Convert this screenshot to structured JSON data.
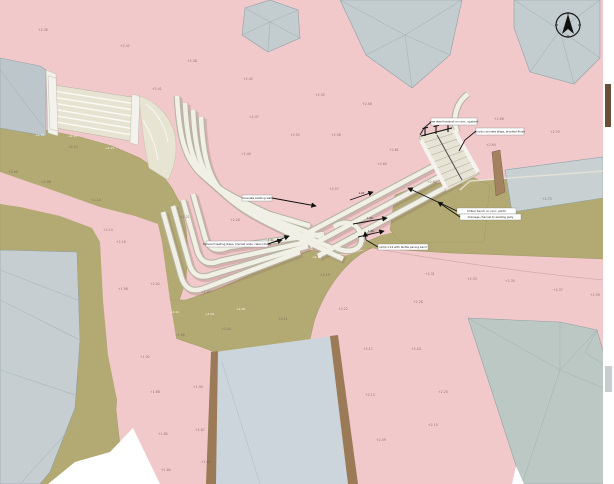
{
  "drawing": {
    "kind": "landscape site plan render",
    "colors": {
      "plaza_pink": "#f2c9cb",
      "path_olive": "#b3aa73",
      "water": "#ccd5dc",
      "water_edge_brown": "#9b7a58",
      "building_gray": "#c3ccce",
      "building_green_gray": "#bcc8c3",
      "steps_cream": "#f1f0e6",
      "steps_edge": "#b7b4a2",
      "timber": "#a3825f",
      "annotation_ink": "#111111"
    }
  },
  "north_arrow": {
    "name": "north-arrow"
  },
  "annotations": [
    {
      "text": "new steel handrail on conc. upstand",
      "box": [
        431,
        118,
        46,
        7
      ],
      "leader": [
        [
          431,
          122
        ],
        [
          424,
          128
        ],
        [
          420,
          135
        ]
      ],
      "arrow": false
    },
    {
      "text": "in-situ concrete steps, brushed finish",
      "box": [
        476,
        128,
        48,
        7
      ],
      "leader": [
        [
          476,
          131
        ],
        [
          465,
          140
        ],
        [
          459,
          151
        ]
      ],
      "arrow": false
    },
    {
      "text": "renovate existing wall",
      "box": [
        242,
        195,
        30,
        6
      ],
      "leader": [
        [
          272,
          198
        ],
        [
          316,
          206
        ]
      ],
      "arrow": true
    },
    {
      "text": "terraced seating steps, precast units, clean (draft)",
      "box": [
        206,
        241,
        62,
        6
      ],
      "leader": [
        [
          268,
          244
        ],
        [
          289,
          236
        ]
      ],
      "arrow": true
    },
    {
      "text": "ramp 1:12 with tactile paving band",
      "box": [
        378,
        244,
        50,
        6
      ],
      "leader": [
        [
          378,
          247
        ],
        [
          366,
          240
        ],
        [
          365,
          232
        ]
      ],
      "arrow": true
    },
    {
      "text": "timber bench on conc. plinth",
      "box": [
        457,
        208,
        59,
        6
      ],
      "leader": [
        [
          457,
          211
        ],
        [
          408,
          188
        ]
      ],
      "arrow": true
    },
    {
      "text": "drainage channel to existing gully",
      "box": [
        460,
        214,
        61,
        6
      ],
      "leader": [
        [
          460,
          217
        ],
        [
          438,
          202
        ]
      ],
      "arrow": true
    }
  ],
  "slope_arrows": [
    {
      "label": "1:20",
      "from": [
        353,
        224
      ],
      "to": [
        387,
        218
      ]
    },
    {
      "label": "1:20",
      "from": [
        358,
        237
      ],
      "to": [
        384,
        231
      ]
    },
    {
      "label": "1:21",
      "from": [
        260,
        246
      ],
      "to": [
        282,
        240
      ]
    },
    {
      "label": "1:20",
      "from": [
        350,
        200
      ],
      "to": [
        373,
        192
      ]
    }
  ],
  "spot_elevations": [
    {
      "x": 38,
      "y": 31,
      "v": "+2.36"
    },
    {
      "x": 120,
      "y": 47,
      "v": "+2.42"
    },
    {
      "x": 187,
      "y": 62,
      "v": "+2.38"
    },
    {
      "x": 243,
      "y": 80,
      "v": "+2.45"
    },
    {
      "x": 152,
      "y": 90,
      "v": "+2.41"
    },
    {
      "x": 249,
      "y": 118,
      "v": "+2.47"
    },
    {
      "x": 290,
      "y": 136,
      "v": "+2.52"
    },
    {
      "x": 241,
      "y": 155,
      "v": "+2.49"
    },
    {
      "x": 315,
      "y": 96,
      "v": "+2.55"
    },
    {
      "x": 362,
      "y": 105,
      "v": "+2.58"
    },
    {
      "x": 331,
      "y": 136,
      "v": "+2.56"
    },
    {
      "x": 389,
      "y": 151,
      "v": "+2.61"
    },
    {
      "x": 377,
      "y": 165,
      "v": "+2.60"
    },
    {
      "x": 329,
      "y": 190,
      "v": "+2.57"
    },
    {
      "x": 494,
      "y": 120,
      "v": "+2.66"
    },
    {
      "x": 550,
      "y": 133,
      "v": "+2.70"
    },
    {
      "x": 486,
      "y": 146,
      "v": "+2.64"
    },
    {
      "x": 542,
      "y": 200,
      "v": "+2.73"
    },
    {
      "x": 427,
      "y": 183,
      "v": "+2.62"
    },
    {
      "x": 68,
      "y": 148,
      "v": "+2.12"
    },
    {
      "x": 8,
      "y": 173,
      "v": "+2.05"
    },
    {
      "x": 41,
      "y": 183,
      "v": "+2.08"
    },
    {
      "x": 91,
      "y": 201,
      "v": "+2.10"
    },
    {
      "x": 180,
      "y": 218,
      "v": "+2.21"
    },
    {
      "x": 230,
      "y": 221,
      "v": "+2.26"
    },
    {
      "x": 103,
      "y": 231,
      "v": "+2.14"
    },
    {
      "x": 116,
      "y": 243,
      "v": "+2.16"
    },
    {
      "x": 118,
      "y": 290,
      "v": "+1.98"
    },
    {
      "x": 150,
      "y": 285,
      "v": "+2.02"
    },
    {
      "x": 201,
      "y": 293,
      "v": "+2.07"
    },
    {
      "x": 278,
      "y": 320,
      "v": "+2.11"
    },
    {
      "x": 221,
      "y": 330,
      "v": "+2.04"
    },
    {
      "x": 175,
      "y": 336,
      "v": "+1.96"
    },
    {
      "x": 140,
      "y": 358,
      "v": "+1.92"
    },
    {
      "x": 150,
      "y": 393,
      "v": "+1.88"
    },
    {
      "x": 193,
      "y": 388,
      "v": "+1.90"
    },
    {
      "x": 158,
      "y": 435,
      "v": "+1.85"
    },
    {
      "x": 195,
      "y": 431,
      "v": "+1.87"
    },
    {
      "x": 201,
      "y": 463,
      "v": "+1.82"
    },
    {
      "x": 161,
      "y": 471,
      "v": "+1.80"
    },
    {
      "x": 425,
      "y": 275,
      "v": "+2.31"
    },
    {
      "x": 467,
      "y": 280,
      "v": "+2.33"
    },
    {
      "x": 505,
      "y": 282,
      "v": "+2.35"
    },
    {
      "x": 553,
      "y": 291,
      "v": "+2.37"
    },
    {
      "x": 590,
      "y": 296,
      "v": "+2.39"
    },
    {
      "x": 413,
      "y": 303,
      "v": "+2.28"
    },
    {
      "x": 338,
      "y": 310,
      "v": "+2.22"
    },
    {
      "x": 320,
      "y": 276,
      "v": "+2.19"
    },
    {
      "x": 363,
      "y": 350,
      "v": "+2.17"
    },
    {
      "x": 411,
      "y": 350,
      "v": "+2.24"
    },
    {
      "x": 365,
      "y": 396,
      "v": "+2.13"
    },
    {
      "x": 438,
      "y": 393,
      "v": "+2.20"
    },
    {
      "x": 428,
      "y": 426,
      "v": "+2.15"
    },
    {
      "x": 376,
      "y": 441,
      "v": "+2.09"
    }
  ],
  "white_marks": [
    {
      "x": 35,
      "y": 136,
      "v": "+2.10"
    },
    {
      "x": 68,
      "y": 137,
      "v": "+2.12"
    },
    {
      "x": 105,
      "y": 149,
      "v": "+2.15"
    },
    {
      "x": 170,
      "y": 313,
      "v": "+2.02"
    },
    {
      "x": 205,
      "y": 315,
      "v": "+2.04"
    },
    {
      "x": 236,
      "y": 310,
      "v": "+2.06"
    },
    {
      "x": 312,
      "y": 258,
      "v": "+2.18"
    },
    {
      "x": 332,
      "y": 256,
      "v": "+2.20"
    }
  ]
}
